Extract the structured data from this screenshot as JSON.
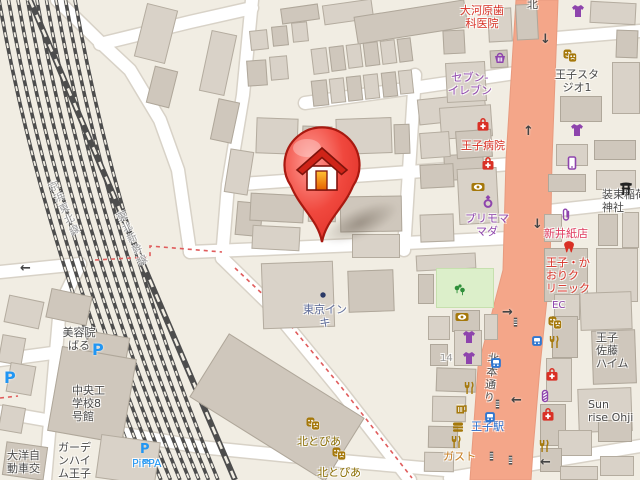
{
  "map": {
    "title": "王子駅周辺の地図（住所ピン付き）",
    "palette": {
      "red": "#d93025",
      "rose": "#e03a5f",
      "purple": "#8e44ad",
      "gold": "#8a6d00",
      "icon_gold": "#a5780a",
      "dark": "#4a4a4a",
      "blue": "#2a6fce",
      "lightblue": "#2196f3",
      "slate": "#5d6b99",
      "orange": "#c77c1e",
      "gray": "#9a9a9a",
      "roadtext": "#4d4d4d",
      "main_road_fill": "#f4a689",
      "background": "#f1ede3",
      "pin_red": "#e03128"
    },
    "pin": {
      "description": "選択地点（家アイコンのピン）",
      "x": 322,
      "y": 242
    },
    "labels": [
      {
        "text": "大河原歯\n科医院",
        "x": 458,
        "y": 4,
        "c": "red",
        "s": 11,
        "w": 48,
        "align": "center",
        "interact": true
      },
      {
        "text": "セブン-\nイレブン",
        "x": 444,
        "y": 71,
        "c": "purple",
        "s": 11,
        "w": 52,
        "align": "center",
        "interact": true
      },
      {
        "text": "王子スタ\nジオ1",
        "x": 552,
        "y": 68,
        "c": "dark",
        "s": 11,
        "w": 50,
        "align": "center",
        "interact": true
      },
      {
        "text": "王子病院",
        "x": 461,
        "y": 139,
        "c": "red",
        "s": 11,
        "interact": true
      },
      {
        "text": "プリモマ\nマダ",
        "x": 462,
        "y": 212,
        "c": "purple",
        "s": 11,
        "w": 50,
        "align": "center",
        "interact": true
      },
      {
        "text": "新井紙店",
        "x": 544,
        "y": 227,
        "c": "rose",
        "s": 11,
        "interact": true
      },
      {
        "text": "装束稲荷\n神社",
        "x": 602,
        "y": 188,
        "c": "dark",
        "s": 11,
        "interact": true
      },
      {
        "text": "王子・か\nおりク\nリニック",
        "x": 546,
        "y": 256,
        "c": "red",
        "s": 11,
        "interact": true
      },
      {
        "text": "東京イン\nキ",
        "x": 301,
        "y": 303,
        "c": "slate",
        "s": 11,
        "w": 48,
        "align": "center",
        "interact": true
      },
      {
        "text": "北とぴあ",
        "x": 297,
        "y": 435,
        "c": "gold",
        "s": 11,
        "interact": true
      },
      {
        "text": "北とぴあ",
        "x": 317,
        "y": 466,
        "c": "gold",
        "s": 11,
        "interact": true
      },
      {
        "text": "王子駅",
        "x": 471,
        "y": 420,
        "c": "blue",
        "s": 11,
        "interact": true
      },
      {
        "text": "ガスト",
        "x": 443,
        "y": 450,
        "c": "orange",
        "s": 11,
        "interact": true
      },
      {
        "text": "王子\n佐藤\nハイム",
        "x": 596,
        "y": 331,
        "c": "dark",
        "s": 11,
        "interact": false
      },
      {
        "text": "Sun\nrise Ohji",
        "x": 588,
        "y": 398,
        "c": "dark",
        "s": 11,
        "interact": false
      },
      {
        "text": "美容院\nばる",
        "x": 60,
        "y": 326,
        "c": "dark",
        "s": 11,
        "w": 38,
        "align": "center",
        "interact": true
      },
      {
        "text": "中央工\n学校8\n号館",
        "x": 72,
        "y": 384,
        "c": "dark",
        "s": 11,
        "interact": false
      },
      {
        "text": "ガーデ\nンハイ\nム王子",
        "x": 58,
        "y": 441,
        "c": "dark",
        "s": 11,
        "interact": false
      },
      {
        "text": "大洋自\n動車交",
        "x": 7,
        "y": 449,
        "c": "dark",
        "s": 11,
        "interact": false
      },
      {
        "text": "PiPPA",
        "x": 132,
        "y": 457,
        "c": "lightblue",
        "s": 11,
        "interact": true
      },
      {
        "text": "14",
        "x": 440,
        "y": 352,
        "c": "gray",
        "s": 10,
        "interact": false
      },
      {
        "text": "EC",
        "x": 552,
        "y": 299,
        "c": "purple",
        "s": 10,
        "interact": false
      },
      {
        "text": "北本通り",
        "x": 487,
        "y": 352,
        "c": "roadtext",
        "s": 11,
        "vertical": true,
        "rotate": 6,
        "interact": false
      },
      {
        "text": "北",
        "x": 527,
        "y": -2,
        "c": "roadtext",
        "s": 11,
        "interact": false
      },
      {
        "text": "京浜東北線",
        "x": 44,
        "y": 185,
        "c": "gray",
        "s": 10,
        "vertical": true,
        "rotate": -25,
        "interact": false
      },
      {
        "text": "東北新幹線",
        "x": 112,
        "y": 215,
        "c": "gray",
        "s": 10,
        "vertical": true,
        "rotate": -25,
        "interact": false
      }
    ],
    "icons": [
      {
        "name": "convenience-store-basket-icon",
        "type": "basket",
        "x": 492,
        "y": 50,
        "c": "#8e44ad"
      },
      {
        "name": "clothing-store-icon",
        "type": "tshirt",
        "x": 570,
        "y": 3,
        "c": "#8e44ad"
      },
      {
        "name": "clothing-store-icon",
        "type": "tshirt",
        "x": 569,
        "y": 122,
        "c": "#8e44ad"
      },
      {
        "name": "clothing-store-icon",
        "type": "tshirt",
        "x": 461,
        "y": 329,
        "c": "#8e44ad"
      },
      {
        "name": "clothing-store-icon",
        "type": "tshirt",
        "x": 461,
        "y": 350,
        "c": "#8e44ad"
      },
      {
        "name": "jewelry-ring-icon",
        "type": "ring",
        "x": 480,
        "y": 193,
        "c": "#8e44ad"
      },
      {
        "name": "mobile-phone-shop-icon",
        "type": "phone",
        "x": 564,
        "y": 155,
        "c": "#8e44ad"
      },
      {
        "name": "stationery-clip-icon",
        "type": "clip",
        "x": 558,
        "y": 207,
        "c": "#8e44ad"
      },
      {
        "name": "barber-pole-icon",
        "type": "pole",
        "x": 537,
        "y": 388,
        "c": "#8e44ad"
      },
      {
        "name": "hospital-icon",
        "type": "medbag",
        "x": 475,
        "y": 117,
        "c": "#d93025"
      },
      {
        "name": "clinic-icon",
        "type": "medbag",
        "x": 480,
        "y": 156,
        "c": "#d93025"
      },
      {
        "name": "dental-clinic-icon",
        "type": "tooth",
        "x": 561,
        "y": 239,
        "c": "#d93025"
      },
      {
        "name": "clinic-icon",
        "type": "medbag",
        "x": 544,
        "y": 367,
        "c": "#d93025"
      },
      {
        "name": "clinic-icon",
        "type": "medbag",
        "x": 540,
        "y": 407,
        "c": "#d93025"
      },
      {
        "name": "theater-masks-icon",
        "type": "masks",
        "x": 562,
        "y": 48,
        "c": "#a5780a"
      },
      {
        "name": "theater-masks-icon",
        "type": "masks",
        "x": 547,
        "y": 315,
        "c": "#a5780a"
      },
      {
        "name": "optician-icon",
        "type": "eye",
        "x": 470,
        "y": 179,
        "c": "#a5780a"
      },
      {
        "name": "optician-icon",
        "type": "eye",
        "x": 454,
        "y": 309,
        "c": "#a5780a"
      },
      {
        "name": "restaurant-icon",
        "type": "fork",
        "x": 546,
        "y": 334,
        "c": "#a5780a"
      },
      {
        "name": "restaurant-icon",
        "type": "fork",
        "x": 461,
        "y": 380,
        "c": "#a5780a"
      },
      {
        "name": "pub-icon",
        "type": "beer",
        "x": 453,
        "y": 400,
        "c": "#a5780a"
      },
      {
        "name": "fastfood-icon",
        "type": "burger",
        "x": 450,
        "y": 419,
        "c": "#a5780a"
      },
      {
        "name": "restaurant-icon",
        "type": "fork",
        "x": 448,
        "y": 434,
        "c": "#a5780a"
      },
      {
        "name": "restaurant-icon",
        "type": "fork",
        "x": 536,
        "y": 438,
        "c": "#a5780a"
      },
      {
        "name": "theater-masks-icon",
        "type": "masks",
        "x": 305,
        "y": 416,
        "c": "#a5780a"
      },
      {
        "name": "theater-masks-icon",
        "type": "masks",
        "x": 331,
        "y": 446,
        "c": "#a5780a"
      },
      {
        "name": "park-trees-icon",
        "type": "tree",
        "x": 452,
        "y": 282,
        "c": "#2f8f3a"
      },
      {
        "name": "station-icon",
        "type": "train",
        "x": 531,
        "y": 335,
        "c": "#2f77d1"
      },
      {
        "name": "station-icon",
        "type": "train",
        "x": 490,
        "y": 357,
        "c": "#2f77d1"
      },
      {
        "name": "station-icon",
        "type": "train",
        "x": 484,
        "y": 411,
        "c": "#2f77d1"
      },
      {
        "name": "parking-icon",
        "type": "pletter",
        "x": 92,
        "y": 340,
        "c": "#2196f3"
      },
      {
        "name": "parking-icon",
        "type": "pletter",
        "x": 4,
        "y": 368,
        "c": "#2196f3"
      },
      {
        "name": "bike-share-icon",
        "type": "pippa",
        "x": 140,
        "y": 438,
        "c": "#2196f3"
      },
      {
        "name": "shrine-torii-icon",
        "type": "torii",
        "x": 618,
        "y": 180,
        "c": "#222222"
      },
      {
        "name": "crosswalk-icon",
        "type": "ladder",
        "x": 510,
        "y": 316,
        "c": "#555555"
      },
      {
        "name": "crosswalk-icon",
        "type": "ladder",
        "x": 486,
        "y": 450,
        "c": "#555555"
      },
      {
        "name": "crosswalk-icon",
        "type": "ladder",
        "x": 505,
        "y": 454,
        "c": "#555555"
      },
      {
        "name": "crosswalk-icon",
        "type": "ladder",
        "x": 492,
        "y": 398,
        "c": "#555555"
      },
      {
        "name": "company-marker-icon",
        "type": "dot",
        "x": 317,
        "y": 289,
        "c": "#2b3a67"
      },
      {
        "name": "oneway-arrow-icon",
        "type": "arrow",
        "glyph": "↓",
        "x": 540,
        "y": 32,
        "c": "#444444"
      },
      {
        "name": "oneway-arrow-icon",
        "type": "arrow",
        "glyph": "↑",
        "x": 523,
        "y": 124,
        "c": "#444444"
      },
      {
        "name": "oneway-arrow-icon",
        "type": "arrow",
        "glyph": "↓",
        "x": 532,
        "y": 217,
        "c": "#444444"
      },
      {
        "name": "oneway-arrow-icon",
        "type": "arrow",
        "glyph": "→",
        "x": 502,
        "y": 305,
        "c": "#444444"
      },
      {
        "name": "oneway-arrow-icon",
        "type": "arrow",
        "glyph": "←",
        "x": 511,
        "y": 393,
        "c": "#444444"
      },
      {
        "name": "oneway-arrow-icon",
        "type": "arrow",
        "glyph": "←",
        "x": 540,
        "y": 455,
        "c": "#444444"
      },
      {
        "name": "oneway-arrow-icon",
        "type": "arrow",
        "glyph": "←",
        "x": 20,
        "y": 261,
        "c": "#444444"
      }
    ]
  }
}
